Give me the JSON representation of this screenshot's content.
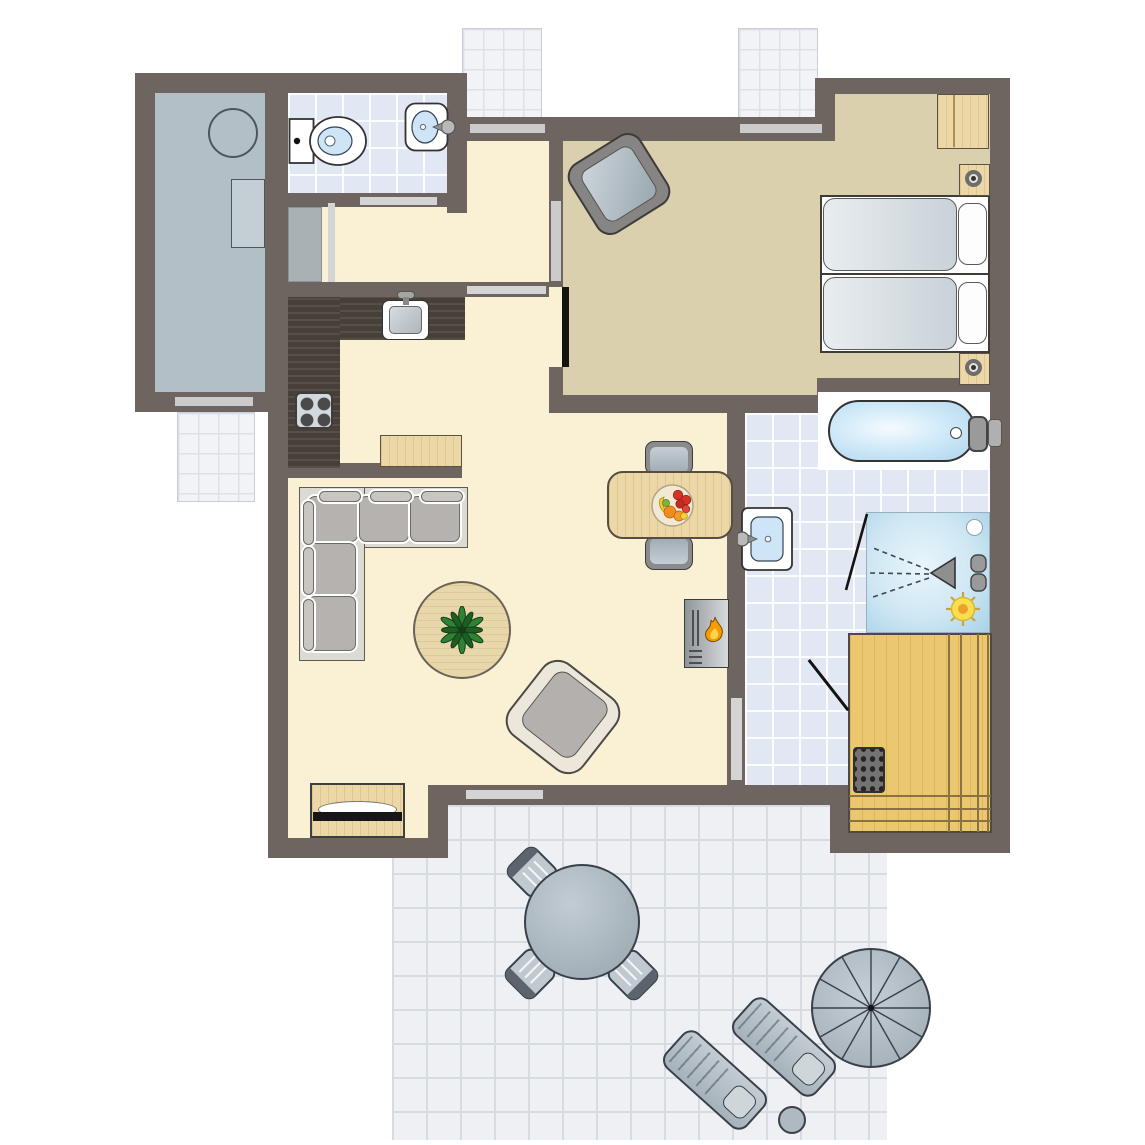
{
  "meta": {
    "title": "Holiday home floor plan",
    "view": "top-down architectural plan",
    "description": "Top-down floor plan of a one-bedroom holiday home with living room, open kitchen, hallway, toilet room, storage room, bedroom with two single beds, bathroom with bathtub and shower, sauna, and a tiled terrace with garden furniture.",
    "visible_text": "none"
  },
  "palette": {
    "wall": "#6e6460",
    "outside": "#ffffff",
    "living_floor": "#faf0d4",
    "bedroom_floor": "#dbd0ae",
    "storage_floor": "#b2bfc7",
    "bathroom_tile": "#e2e8f3",
    "terrace_tile": "#eef0f3",
    "paving_tile": "#f1f3f7",
    "counter_dark_wood": "#474038",
    "light_wood": "#ecd8a6",
    "sauna_wood": "#ebc76f",
    "upholstery_gray": "#b6b2af",
    "outdoor_furniture_gray": "#bfc9cf",
    "water_blue": "#cde5f6",
    "flame_orange": "#f59c00",
    "sun_yellow": "#f8df4b",
    "window_bar": "#cbcbcb",
    "door_leaf_black": "#15130f"
  },
  "rooms": [
    {
      "id": "storage-room",
      "label": "Storage room",
      "furniture": [
        "boiler",
        "appliance"
      ]
    },
    {
      "id": "toilet-room",
      "label": "Toilet room",
      "furniture": [
        "toilet",
        "washbasin"
      ]
    },
    {
      "id": "hallway",
      "label": "Hallway",
      "furniture": [
        "built-in closet"
      ]
    },
    {
      "id": "kitchen",
      "label": "Kitchen",
      "furniture": [
        "L-shaped counter",
        "sink",
        "stove with 4 burners",
        "side table",
        "partition half-wall"
      ]
    },
    {
      "id": "living-room",
      "label": "Living room",
      "furniture": [
        "corner sofa",
        "round rug with plant",
        "armchair",
        "dining table",
        "2 dining chairs",
        "fruit bowl",
        "fireplace",
        "TV sideboard"
      ]
    },
    {
      "id": "bedroom",
      "label": "Bedroom",
      "furniture": [
        "2 single beds",
        "2 pillows",
        "2 bedside lamps",
        "wardrobe cabinet",
        "armchair"
      ]
    },
    {
      "id": "bathroom",
      "label": "Bathroom",
      "furniture": [
        "bathtub",
        "washbasin",
        "shower",
        "heat lamp"
      ]
    },
    {
      "id": "sauna",
      "label": "Sauna",
      "furniture": [
        "benches",
        "sauna heater"
      ]
    },
    {
      "id": "terrace",
      "label": "Terrace",
      "furniture": [
        "round table",
        "3 chairs",
        "2 sun loungers",
        "parasol",
        "side table"
      ]
    }
  ],
  "openings": {
    "windows": 5,
    "door_openings": 7,
    "door_leaves": [
      "bedroom-door",
      "sauna-door",
      "shower-door"
    ]
  },
  "counts": {
    "beds": 2,
    "bathrooms": 2,
    "outdoor_paved_patches": 3
  }
}
